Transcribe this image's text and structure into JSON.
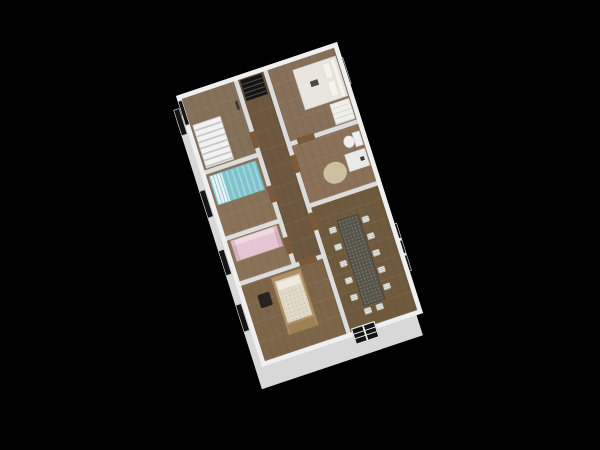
{
  "scene": {
    "description": "Isometric 3D render of a single-storey house floor plan on a black background",
    "background_color": "#000000"
  },
  "palette": {
    "wall_top": "#efefef",
    "wall_inner": "#dcdcdc",
    "wall_band": "#d8d8d8",
    "window_glass": "#141414",
    "threshold_wood": "#7a5a3a",
    "floor_stairs_room": "#85705a",
    "floor_closet_hall": "#6d573f",
    "floor_bedroom_top": "#87705a",
    "floor_bedroom_teal": "#8a7258",
    "floor_bathroom": "#8b7157",
    "floor_bedroom_pink": "#8a7258",
    "floor_bedroom_bottom": "#7d6549",
    "floor_dining": "#6f5a3e",
    "stair_treads": "#e9e9e9",
    "shelf_dark": "#141414",
    "bed_white": "#e9e6e0",
    "wardrobe_white": "#f0efec",
    "bed_teal": "#7fc3cc",
    "sofa_pink": "#e6c6d2",
    "bed_wood_frame": "#ad9065",
    "bed_wood_foot": "#9c8154",
    "mattress_cream": "#e0d9c8",
    "pillow_cream": "#efeadd",
    "chair_dark": "#2a221c",
    "toilet_white": "#efefef",
    "fixture_white": "#eaeaea",
    "fixture_dark_detail": "#3a3a3a",
    "rug_beige": "#cdbfa0",
    "table_dark": "#57544b",
    "chair_white": "#e8e8e2",
    "laptop_dark": "#4a4a4a",
    "wall_item_dark": "#3a3a3a"
  },
  "rooms": [
    {
      "id": "staircase-room",
      "label": "Staircase room"
    },
    {
      "id": "closet",
      "label": "Closet"
    },
    {
      "id": "bedroom-top",
      "label": "Bedroom (white bed)"
    },
    {
      "id": "hallway",
      "label": "Hallway"
    },
    {
      "id": "bedroom-teal",
      "label": "Bedroom (teal bed)"
    },
    {
      "id": "bathroom",
      "label": "Bathroom"
    },
    {
      "id": "bedroom-pink",
      "label": "Room (pink sofa)"
    },
    {
      "id": "bedroom-bottom",
      "label": "Bedroom (wood bed)"
    },
    {
      "id": "dining-room",
      "label": "Dining room"
    }
  ],
  "furniture": [
    {
      "room": "staircase-room",
      "items": [
        "staircase",
        "wall-mounted-item"
      ]
    },
    {
      "room": "closet",
      "items": [
        "slatted-shelf"
      ]
    },
    {
      "room": "bedroom-top",
      "items": [
        "double-bed-white",
        "wardrobe",
        "laptop-on-bed"
      ]
    },
    {
      "room": "bedroom-teal",
      "items": [
        "single-bed-teal"
      ]
    },
    {
      "room": "bathroom",
      "items": [
        "toilet",
        "washbasin-unit",
        "oval-rug"
      ]
    },
    {
      "room": "bedroom-pink",
      "items": [
        "pink-sofa-bed"
      ]
    },
    {
      "room": "bedroom-bottom",
      "items": [
        "wood-frame-bed",
        "dark-chair"
      ]
    },
    {
      "room": "dining-room",
      "items": [
        "long-dining-table",
        "dining-chairs"
      ]
    }
  ],
  "dining_room": {
    "chairs": {
      "left": 5,
      "right": 5,
      "end": 2
    }
  },
  "openings": {
    "front_door": {
      "wall": "bottom-right",
      "style": "dark glass door with white grid"
    },
    "windows_left_wall": 4,
    "windows_right_wall": 2,
    "window_corner_top": 1,
    "interior_door_thresholds": 7
  }
}
